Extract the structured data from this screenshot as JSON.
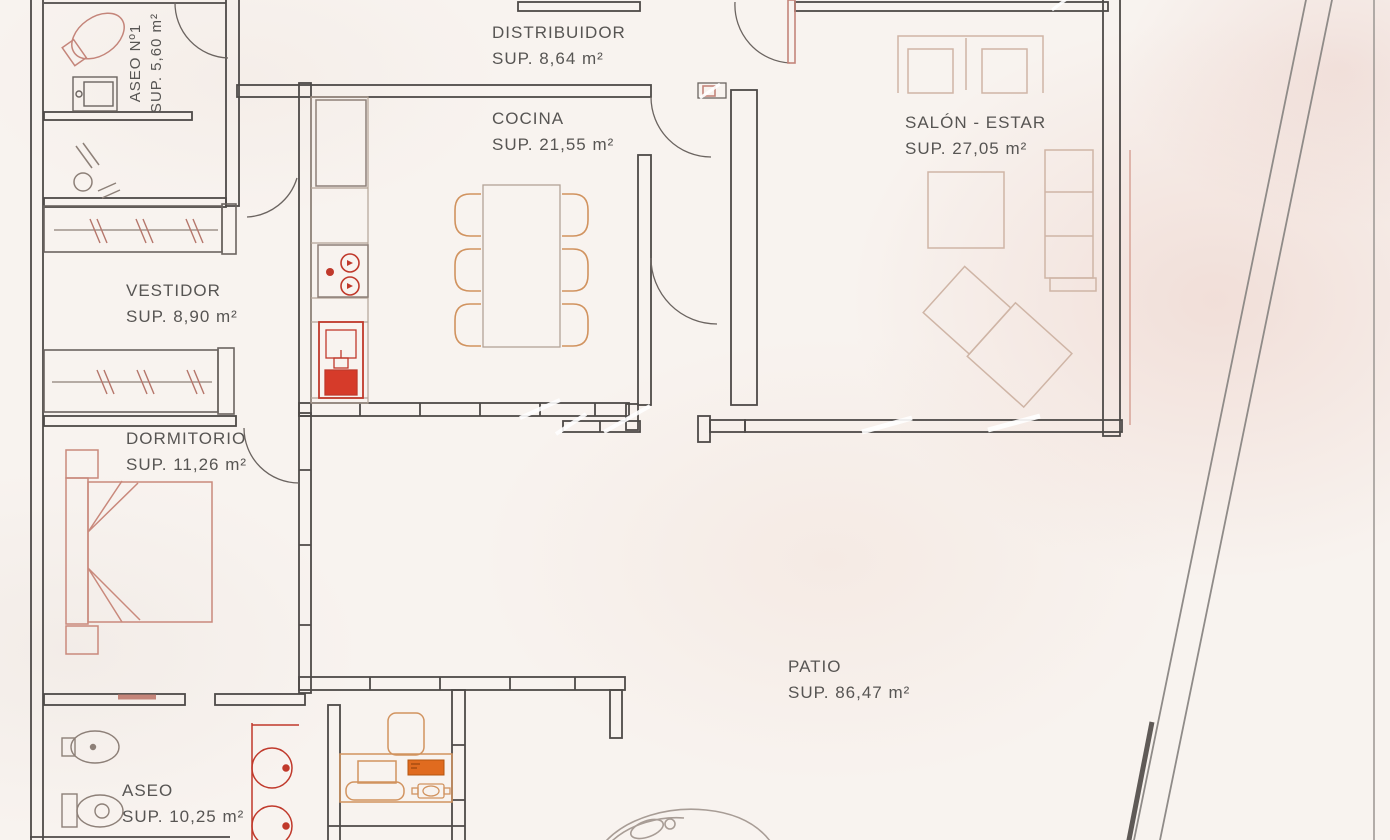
{
  "plan": {
    "kind_label": "floor-plan-drawing"
  },
  "rooms": [
    {
      "id": "distribuidor",
      "name": "DISTRIBUIDOR",
      "area": "SUP. 8,64 m²"
    },
    {
      "id": "cocina",
      "name": "COCINA",
      "area": "SUP. 21,55 m²"
    },
    {
      "id": "salon",
      "name": "SALÓN - ESTAR",
      "area": "SUP. 27,05 m²"
    },
    {
      "id": "aseo1",
      "name": "ASEO Nº1",
      "area": "SUP. 5,60 m²"
    },
    {
      "id": "vestidor",
      "name": "VESTIDOR",
      "area": "SUP. 8,90 m²"
    },
    {
      "id": "dormitorio",
      "name": "DORMITORIO",
      "area": "SUP. 11,26 m²"
    },
    {
      "id": "aseo",
      "name": "ASEO",
      "area": "SUP. 10,25 m²"
    },
    {
      "id": "patio",
      "name": "PATIO",
      "area": "SUP. 86,47 m²"
    }
  ],
  "colors": {
    "paper": "#f8f3ef",
    "wall": "#4e4a48",
    "text": "#575553",
    "fixture_red": "#c0392b",
    "fixture_red_fill": "#d63b2a",
    "salmon": "#c4857a",
    "furniture_tan": "#d1935f",
    "furniture_light": "#cfb5a6",
    "orange_item": "#e06b1f"
  }
}
